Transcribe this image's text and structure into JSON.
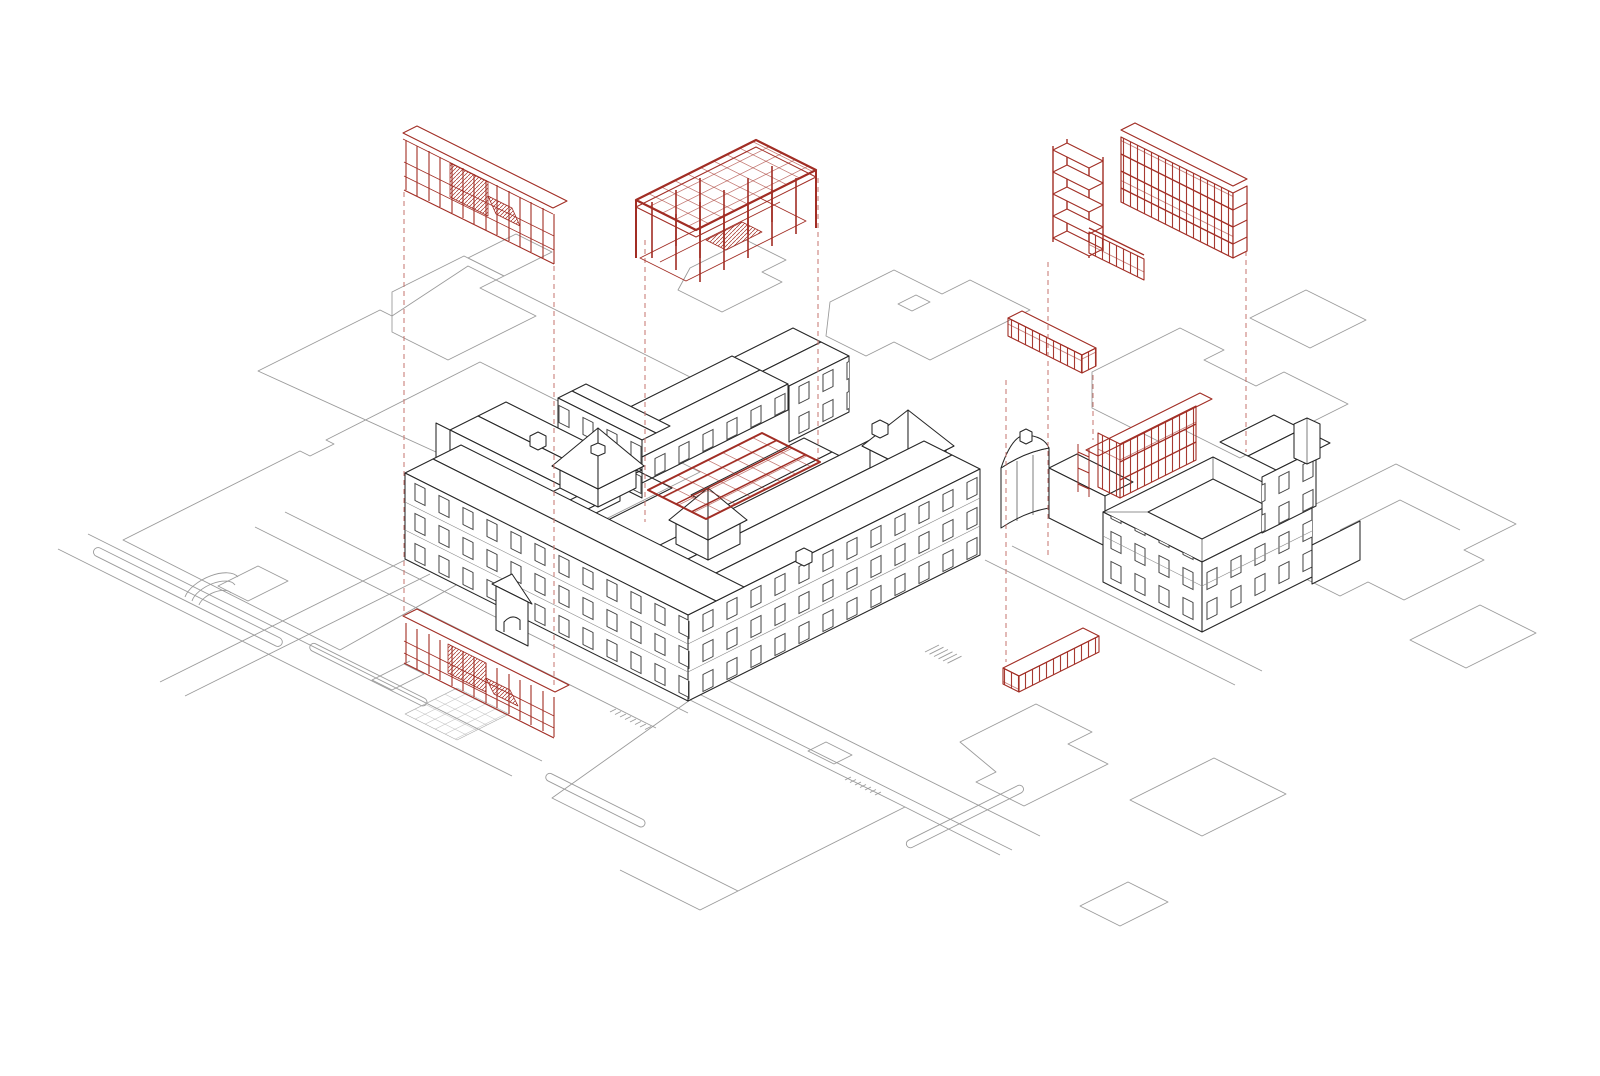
{
  "diagram": {
    "type": "exploded-axonometric-architectural-drawing",
    "background_color": "#ffffff",
    "colors": {
      "paper": "#ffffff",
      "building_line": "#262626",
      "window_line": "#3f3f3f",
      "cornice_line": "#8a8a8a",
      "site_line": "#9b9b9b",
      "site_detail": "#aaaaaa",
      "accent_red": "#a12d24",
      "leader_red": "#c4736c"
    },
    "elements": {
      "exploded": [
        {
          "id": "colonnade-frame",
          "label": "linear colonnade frame"
        },
        {
          "id": "canopy-grid",
          "label": "courtyard canopy grid on columns"
        },
        {
          "id": "frame-tower-wing",
          "label": "multi-storey frame wing with stair tower"
        },
        {
          "id": "raised-walkway",
          "label": "raised walkway bar"
        }
      ],
      "in_place": [
        {
          "id": "courtyard-roof-grid",
          "label": "red courtyard roof grid"
        },
        {
          "id": "base-colonnade",
          "label": "ground-floor colonnade"
        },
        {
          "id": "annex-facade-grid",
          "label": "annex courtyard facade grid"
        },
        {
          "id": "ground-pavilion",
          "label": "low slatted pavilion"
        }
      ]
    },
    "leader_lines": {
      "style": "dashed",
      "count": 8
    }
  }
}
